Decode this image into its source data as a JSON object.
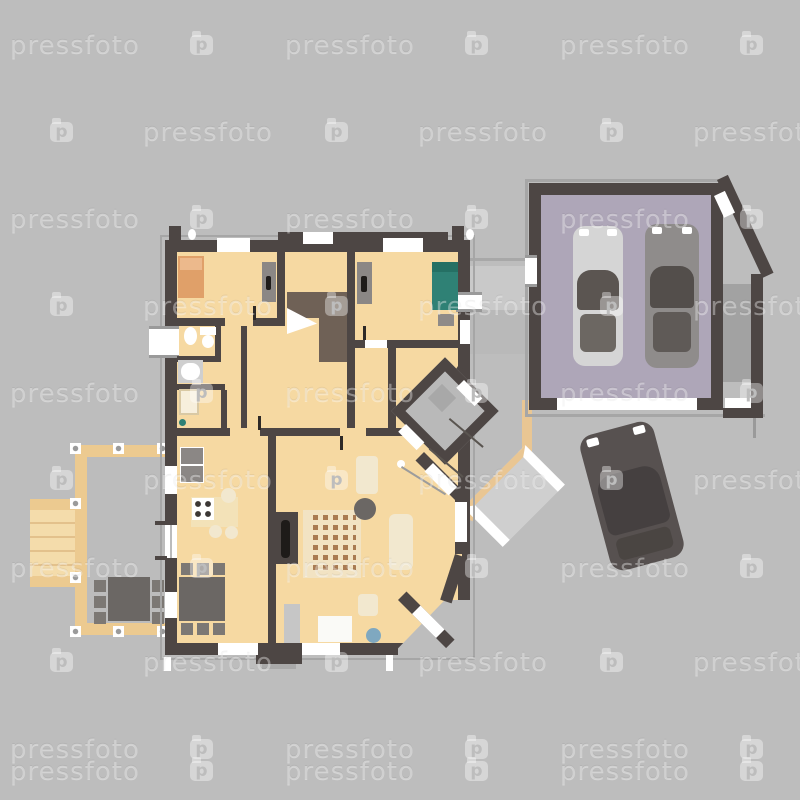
{
  "scene": {
    "description": "Top view floor plan of a house with furniture, attached two-car garage, wooden deck with outdoor dining set, entrance walkways and one car parked on the driveway",
    "cars_in_garage": 2,
    "cars_outside": 1,
    "stock_style": "vector illustration preview with tiled watermark"
  },
  "watermark": {
    "text": "pressfoto",
    "icon_letter": "p",
    "period": 275,
    "offsets": {
      "A": {
        "text_x": 10,
        "icon_x": 190
      },
      "B": {
        "text_x": 143,
        "icon_x": 50
      }
    },
    "rows": [
      {
        "y": 33,
        "type": "A"
      },
      {
        "y": 120,
        "type": "B"
      },
      {
        "y": 207,
        "type": "A"
      },
      {
        "y": 294,
        "type": "B"
      },
      {
        "y": 381,
        "type": "A"
      },
      {
        "y": 468,
        "type": "B"
      },
      {
        "y": 556,
        "type": "A"
      },
      {
        "y": 650,
        "type": "B"
      },
      {
        "y": 737,
        "type": "A"
      },
      {
        "y": 759,
        "type": "A"
      }
    ]
  },
  "palette": {
    "bg": "#bdbdbd",
    "wm": "rgba(255,255,255,0.38)",
    "wall": "#4d4644",
    "wallOutline": "#a6a6a6",
    "floor": "#f6d9a2",
    "floorLight": "#f3e2b8",
    "cream": "#f2e8cf",
    "white": "#ffffff",
    "stairBrown": "#6f6156",
    "rugBase": "#f2e3c3",
    "rugDot": "#a97b52",
    "garageFloor": "#aea6b8",
    "carLight": "#d5d5d5",
    "carDark": "#8f8c8b",
    "carOutside": "#575150",
    "pathLight": "#c9c9c9",
    "pathMid": "#b9b9b9",
    "deckWood": "#ecca90",
    "deckWoodLight": "#f4dcab",
    "deckFloor": "#bcbcbc",
    "tan": "#e9c693",
    "grayObj": "#8b8785",
    "darkObj": "#6b6764",
    "chairGray": "#7c7874",
    "blue": "#7fa8c0",
    "teal": "#2f8175",
    "bedOrange": "#e0a069",
    "bedOrangeLight": "#ecb98c",
    "tub": "#cfcfcf",
    "stripGray": "#a2a2a2"
  }
}
